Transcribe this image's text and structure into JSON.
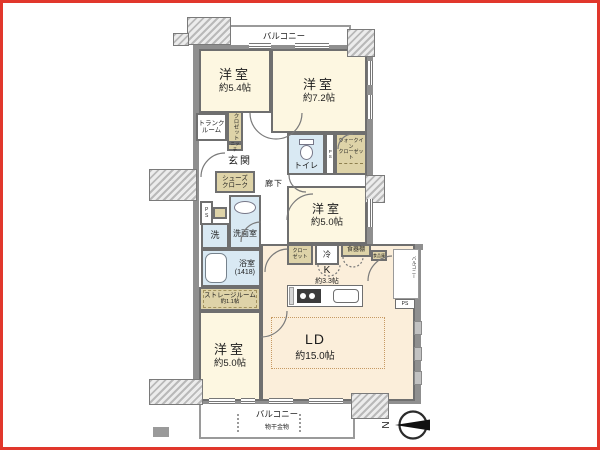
{
  "compass": {
    "label": "N"
  },
  "balconies": {
    "top": "バルコニー",
    "bottom": "バルコニー",
    "bottom_note": "物干金物",
    "side": "バルコニー"
  },
  "rooms": {
    "bed54": {
      "name": "洋室",
      "size": "約5.4帖"
    },
    "bed72": {
      "name": "洋室",
      "size": "約7.2帖"
    },
    "bed50mid": {
      "name": "洋室",
      "size": "約5.0帖"
    },
    "bed50low": {
      "name": "洋室",
      "size": "約5.0帖"
    },
    "ld": {
      "name": "LD",
      "size": "約15.0帖"
    },
    "kitchen": {
      "name": "K",
      "size": "約3.3帖"
    },
    "genkan": "玄関",
    "rouka": "廊下",
    "toilet": "トイレ",
    "wic": {
      "line1": "ウォークイン",
      "line2": "クローゼット"
    },
    "trunk": {
      "line1": "トランク",
      "line2": "ルーム"
    },
    "closet": "クロゼット",
    "niche": "ニッチ",
    "shoes": {
      "line1": "シューズ",
      "line2": "クローク"
    },
    "wash": "洗",
    "senmen": "洗面室",
    "bath": {
      "name": "浴室",
      "size": "(1418)"
    },
    "storage": {
      "name": "ストレージルーム",
      "size": "約1.1帖"
    },
    "kclo": {
      "line1": "クロー",
      "line2": "ゼット"
    },
    "fridge": "冷",
    "cupboard": "食器棚",
    "pantry": "食品庫",
    "ps": "PS",
    "ps2": "PS",
    "ps3": "PS"
  }
}
